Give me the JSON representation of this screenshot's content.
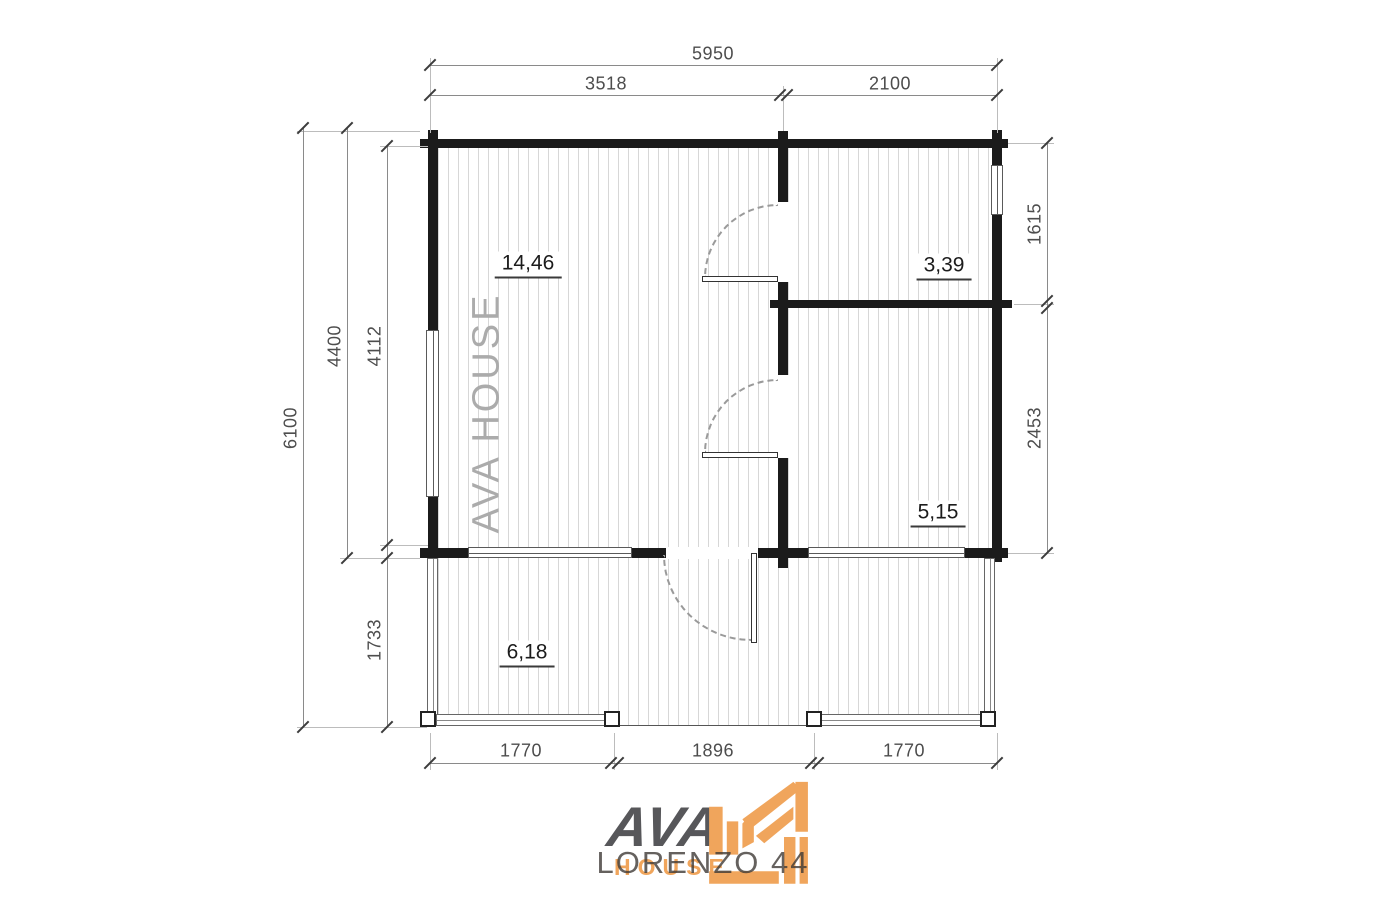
{
  "title": "LORENZO 44 floor plan",
  "watermark": "AVA HOUSE",
  "dimensions": {
    "top": {
      "total": "5950",
      "left_span": "3518",
      "right_span": "2100"
    },
    "left": {
      "total": "6100",
      "cabin_depth": "4400",
      "interior_depth": "4112",
      "terrace_depth": "1733"
    },
    "right": {
      "upper_room": "1615",
      "lower_room": "2453"
    },
    "bottom": {
      "left_rail": "1770",
      "opening": "1896",
      "right_rail": "1770"
    }
  },
  "rooms": [
    {
      "name": "main-room",
      "area": "14,46"
    },
    {
      "name": "upper-right-room",
      "area": "3,39"
    },
    {
      "name": "lower-right-room",
      "area": "5,15"
    },
    {
      "name": "terrace",
      "area": "6,18"
    }
  ],
  "logo": {
    "brand": "AVA",
    "brand_word": "HOUSE",
    "model": "LORENZO 44"
  },
  "colors": {
    "wall": "#1b1b1b",
    "accent_orange": "#f0a55c",
    "brand_gray": "#57575a",
    "dim_line": "#8a8a8a",
    "dim_text": "#4d4d4d",
    "watermark": "#ababab",
    "plank_line": "#d7d7d7"
  }
}
